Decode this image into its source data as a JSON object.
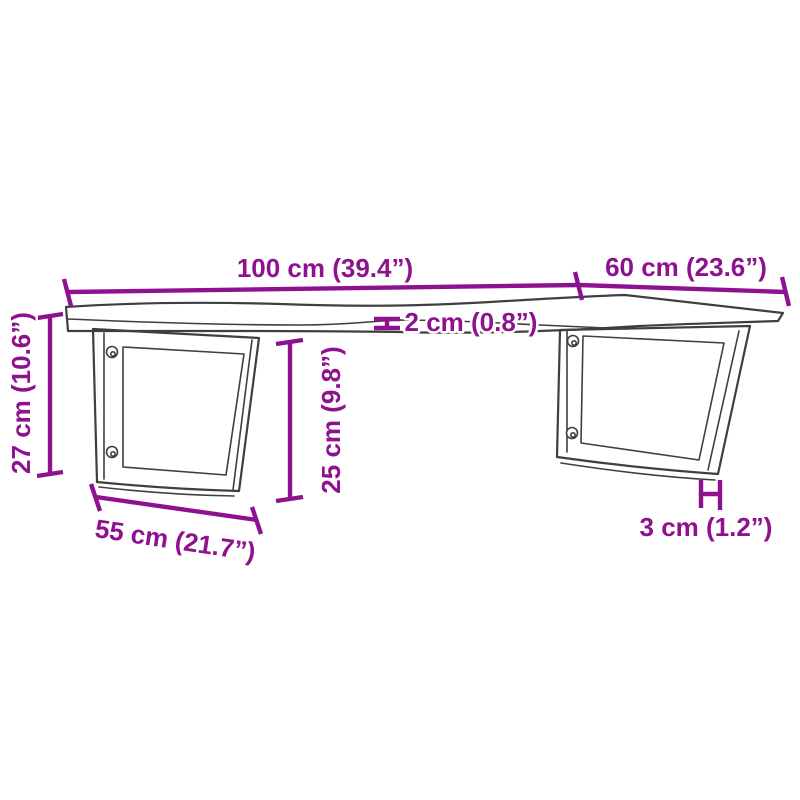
{
  "diagram": {
    "background": "#ffffff",
    "colors": {
      "dimension": "#8E1190",
      "outline": "#3f3f3f",
      "detail": "#5a5a5a"
    },
    "dimensions": {
      "length": {
        "cm": 100,
        "in": 39.4,
        "label": "100 cm (39.4”)"
      },
      "depth": {
        "cm": 60,
        "in": 23.6,
        "label": "60 cm (23.6”)"
      },
      "thickness": {
        "cm": 2,
        "in": 0.8,
        "label": "2 cm (0.8”)"
      },
      "total_height": {
        "cm": 27,
        "in": 10.6,
        "label": "27 cm (10.6”)"
      },
      "bracket_height": {
        "cm": 25,
        "in": 9.8,
        "label": "25 cm (9.8”)"
      },
      "bracket_width": {
        "cm": 55,
        "in": 21.7,
        "label": "55 cm (21.7”)"
      },
      "bracket_depth": {
        "cm": 3,
        "in": 1.2,
        "label": "3 cm (1.2”)"
      }
    }
  }
}
